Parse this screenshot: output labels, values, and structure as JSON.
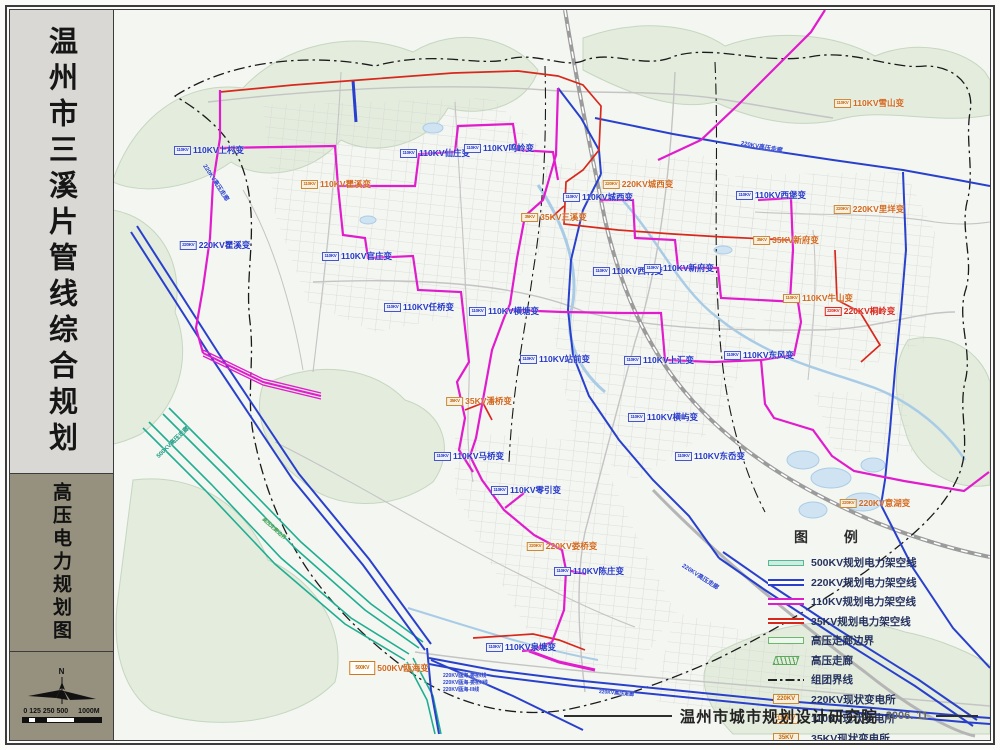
{
  "sidebar": {
    "title": "温州市三溪片管线综合规划",
    "subtitle": "高压电力规划图",
    "compass_label": "N",
    "scale_ticks": [
      "0",
      "125",
      "250",
      "500",
      "1000M"
    ]
  },
  "legend": {
    "title": "图 例",
    "items": [
      {
        "swatch": "line-500kv",
        "label": "500KV规划电力架空线"
      },
      {
        "swatch": "line-220kv",
        "label": "220KV规划电力架空线"
      },
      {
        "swatch": "line-110kv",
        "label": "110KV规划电力架空线"
      },
      {
        "swatch": "line-35kv",
        "label": "35KV规划电力架空线"
      },
      {
        "swatch": "corridor-boundary",
        "label": "高压走廊边界"
      },
      {
        "swatch": "corridor",
        "label": "高压走廊"
      },
      {
        "swatch": "cluster-boundary",
        "label": "组团界线"
      },
      {
        "swatch": "box-existing",
        "swatch_text": "220KV",
        "label": "220KV现状变电所"
      },
      {
        "swatch": "box-existing",
        "swatch_text": "110KV",
        "label": "110KV现状变电所"
      },
      {
        "swatch": "box-existing",
        "swatch_text": "35KV",
        "label": "35KV现状变电所"
      },
      {
        "swatch": "box-planned",
        "swatch_text": "220KV",
        "label": "220KV规划变电所"
      },
      {
        "swatch": "box-planned",
        "swatch_text": "110KV",
        "label": "110KV规划变电所"
      }
    ]
  },
  "footer": {
    "agency": "温州市城市规划设计研究院",
    "date": "2006. 11"
  },
  "map": {
    "colors": {
      "kv500": "#1fae92",
      "kv220": "#2940cc",
      "kv110": "#e01ccd",
      "kv35": "#d8281c",
      "boundary": "#1a1a1a",
      "terrain": "#e3ecdd",
      "water": "#cfe3f2"
    },
    "labels": [
      {
        "t": "110KV上村变",
        "x": 96,
        "y": 140,
        "c": "blue",
        "m": "110KV",
        "s": "p"
      },
      {
        "t": "110KV仙庄变",
        "x": 322,
        "y": 143,
        "c": "blue",
        "m": "110KV",
        "s": "p"
      },
      {
        "t": "110KV鸣岭变",
        "x": 386,
        "y": 138,
        "c": "blue",
        "m": "110KV",
        "s": "p"
      },
      {
        "t": "110KV瞿溪变",
        "x": 223,
        "y": 174,
        "c": "orange",
        "m": "110KV",
        "s": "e"
      },
      {
        "t": "220KV瞿溪变",
        "x": 102,
        "y": 235,
        "c": "blue",
        "m": "220KV",
        "s": "p"
      },
      {
        "t": "110KV官庄变",
        "x": 244,
        "y": 246,
        "c": "blue",
        "m": "110KV",
        "s": "p"
      },
      {
        "t": "220KV城西变",
        "x": 525,
        "y": 174,
        "c": "orange",
        "m": "220KV",
        "s": "e"
      },
      {
        "t": "110KV城西变",
        "x": 485,
        "y": 187,
        "c": "blue",
        "m": "110KV",
        "s": "p"
      },
      {
        "t": "35KV三溪变",
        "x": 441,
        "y": 207,
        "c": "orange",
        "m": "35KV",
        "s": "e"
      },
      {
        "t": "110KV西堡变",
        "x": 658,
        "y": 185,
        "c": "blue",
        "m": "110KV",
        "s": "p"
      },
      {
        "t": "35KV新府变",
        "x": 673,
        "y": 230,
        "c": "orange",
        "m": "35KV",
        "s": "e"
      },
      {
        "t": "110KV雪山变",
        "x": 756,
        "y": 93,
        "c": "orange",
        "m": "110KV",
        "s": "e"
      },
      {
        "t": "220KV里垟变",
        "x": 756,
        "y": 199,
        "c": "orange",
        "m": "220KV",
        "s": "e"
      },
      {
        "t": "110KV西村变",
        "x": 515,
        "y": 261,
        "c": "blue",
        "m": "110KV",
        "s": "p"
      },
      {
        "t": "110KV新府变",
        "x": 566,
        "y": 258,
        "c": "blue",
        "m": "110KV",
        "s": "p"
      },
      {
        "t": "110KV牛山变",
        "x": 705,
        "y": 288,
        "c": "orange",
        "m": "110KV",
        "s": "e"
      },
      {
        "t": "220KV桐岭变",
        "x": 747,
        "y": 301,
        "c": "red",
        "m": "220KV",
        "s": "r"
      },
      {
        "t": "110KV东风变",
        "x": 646,
        "y": 345,
        "c": "blue",
        "m": "110KV",
        "s": "p"
      },
      {
        "t": "110KV上汇变",
        "x": 546,
        "y": 350,
        "c": "blue",
        "m": "110KV",
        "s": "p"
      },
      {
        "t": "110KV站前变",
        "x": 442,
        "y": 349,
        "c": "blue",
        "m": "110KV",
        "s": "p"
      },
      {
        "t": "110KV横塘变",
        "x": 391,
        "y": 301,
        "c": "blue",
        "m": "110KV",
        "s": "p"
      },
      {
        "t": "110KV任桥变",
        "x": 306,
        "y": 297,
        "c": "blue",
        "m": "110KV",
        "s": "p"
      },
      {
        "t": "35KV潘桥变",
        "x": 366,
        "y": 391,
        "c": "orange",
        "m": "35KV",
        "s": "e"
      },
      {
        "t": "110KV横屿变",
        "x": 550,
        "y": 407,
        "c": "blue",
        "m": "110KV",
        "s": "p"
      },
      {
        "t": "110KV马桥变",
        "x": 356,
        "y": 446,
        "c": "blue",
        "m": "110KV",
        "s": "p"
      },
      {
        "t": "110KV东岙变",
        "x": 597,
        "y": 446,
        "c": "blue",
        "m": "110KV",
        "s": "p"
      },
      {
        "t": "110KV零引变",
        "x": 413,
        "y": 480,
        "c": "blue",
        "m": "110KV",
        "s": "p"
      },
      {
        "t": "220KV娄桥变",
        "x": 449,
        "y": 536,
        "c": "orange",
        "m": "220KV",
        "s": "e"
      },
      {
        "t": "110KV陈庄变",
        "x": 476,
        "y": 561,
        "c": "blue",
        "m": "110KV",
        "s": "p"
      },
      {
        "t": "110KV泉塘变",
        "x": 408,
        "y": 637,
        "c": "blue",
        "m": "110KV",
        "s": "p"
      },
      {
        "t": "500KV瓯海变",
        "x": 276,
        "y": 658,
        "c": "orange",
        "m": "500KV",
        "s": "500"
      },
      {
        "t": "220KV意湖变",
        "x": 762,
        "y": 493,
        "c": "orange",
        "m": "220KV",
        "s": "e"
      }
    ],
    "annotations": [
      {
        "t": "220KV瓯海-娄桥I线",
        "x": 330,
        "y": 662,
        "rot": 0,
        "c": "blue",
        "fs": 5
      },
      {
        "t": "220KV瓯海-娄桥II线",
        "x": 330,
        "y": 669,
        "rot": 0,
        "c": "blue",
        "fs": 5
      },
      {
        "t": "220KV瓯海-III线",
        "x": 330,
        "y": 676,
        "rot": 0,
        "c": "blue",
        "fs": 5
      },
      {
        "t": "500KV高压走廊",
        "x": 44,
        "y": 442,
        "rot": -44,
        "c": "teal",
        "fs": 6
      },
      {
        "t": "220KV高压走廊",
        "x": 570,
        "y": 550,
        "rot": 33,
        "c": "blue",
        "fs": 6
      },
      {
        "t": "220KV高压走廊",
        "x": 628,
        "y": 128,
        "rot": 10,
        "c": "blue",
        "fs": 6
      },
      {
        "t": "220KV高压走廊",
        "x": 92,
        "y": 150,
        "rot": 57,
        "c": "blue",
        "fs": 6
      },
      {
        "t": "220KV高压走廊",
        "x": 486,
        "y": 678,
        "rot": 5,
        "c": "blue",
        "fs": 5
      },
      {
        "t": "高压走廊边界",
        "x": 150,
        "y": 505,
        "rot": 42,
        "c": "green",
        "fs": 5
      }
    ]
  }
}
